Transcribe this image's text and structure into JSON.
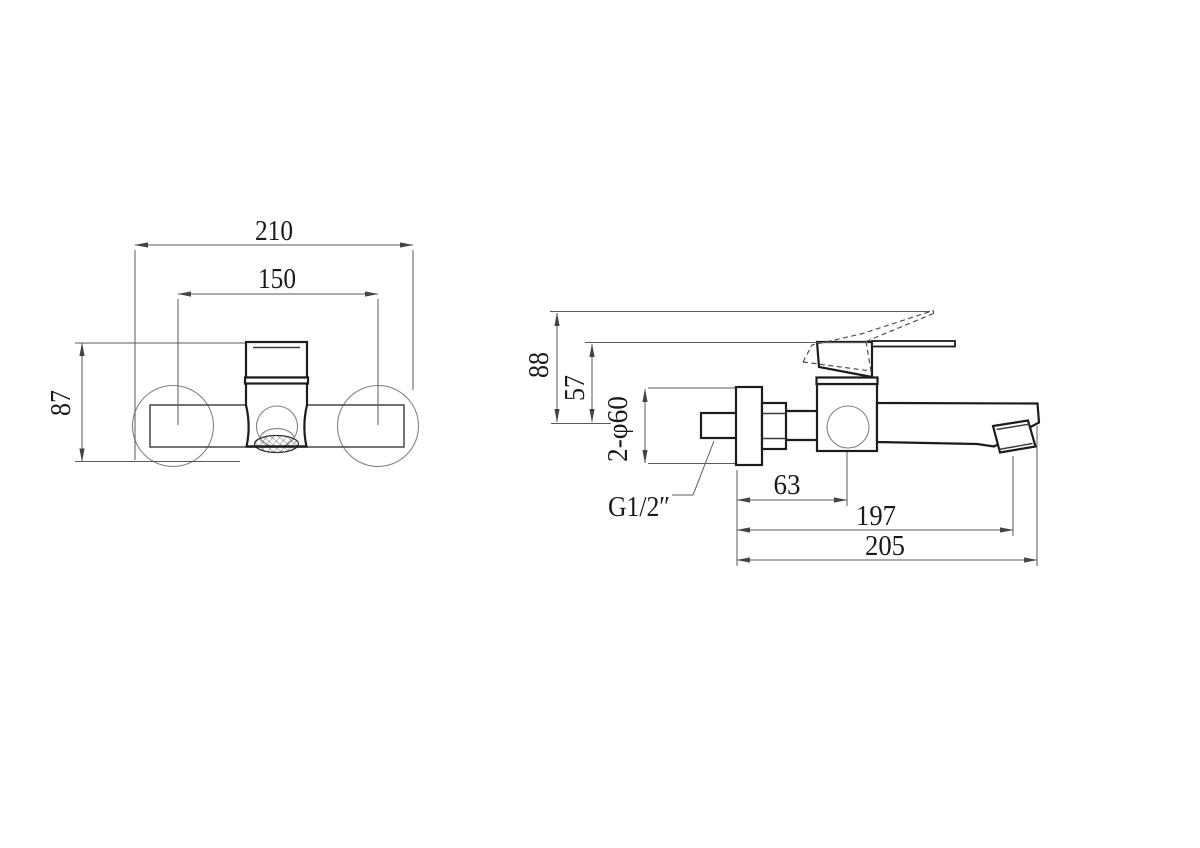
{
  "drawing": {
    "description": "Two-view dimensioned technical line drawing of a wall-mounted single-lever bath mixer tap (front view and side view)",
    "views": {
      "front": {
        "dims": {
          "overall_width": "210",
          "inlet_centers": "150",
          "body_height": "87"
        }
      },
      "side": {
        "dims": {
          "height_handle_open": "88",
          "height_handle": "57",
          "flange_diameter": "2-φ60",
          "inlet_thread": "G1/2″",
          "valve_center_depth": "63",
          "outlet_depth": "197",
          "overall_depth": "205"
        }
      }
    },
    "colors": {
      "object_line": "#1c1c1c",
      "thin_line": "#828282",
      "dimension_line": "#5a5a5a",
      "text": "#1a1a1a",
      "background": "#ffffff"
    }
  }
}
